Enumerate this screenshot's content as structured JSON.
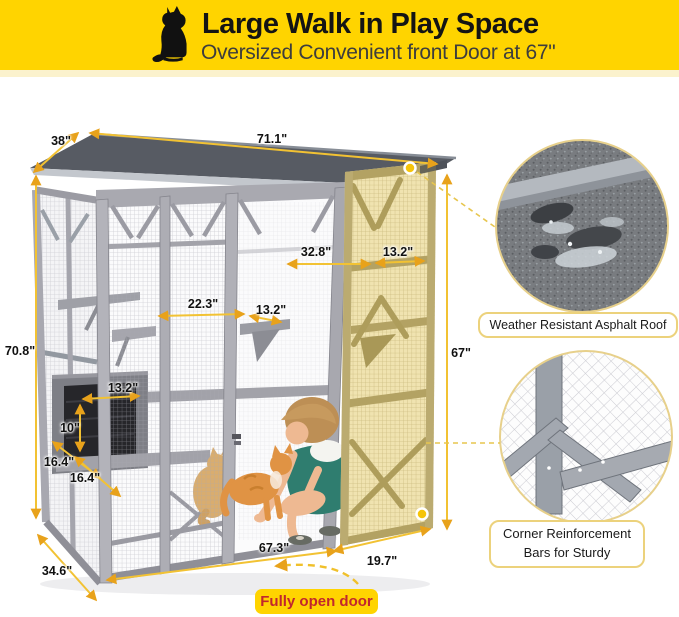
{
  "banner": {
    "title": "Large Walk in Play Space",
    "subtitle": "Oversized Convenient front Door at 67\"",
    "bg_color": "#FFD400",
    "title_color": "#141414",
    "subtitle_color": "#3d3d3d",
    "icon": "black-sitting-cat-silhouette"
  },
  "dims": [
    {
      "id": "roof-depth",
      "label": "38\""
    },
    {
      "id": "roof-width",
      "label": "71.1\""
    },
    {
      "id": "overall-height",
      "label": "70.8\""
    },
    {
      "id": "base-depth",
      "label": "34.6\""
    },
    {
      "id": "base-width",
      "label": "67.3\""
    },
    {
      "id": "door-bottom-width",
      "label": "19.7\""
    },
    {
      "id": "door-height",
      "label": "67\""
    },
    {
      "id": "shelf-gap-right",
      "label": "32.8\""
    },
    {
      "id": "door-shelf-width",
      "label": "13.2\""
    },
    {
      "id": "shelf-gap-mid",
      "label": "22.3\""
    },
    {
      "id": "mid-shelf-width",
      "label": "13.2\""
    },
    {
      "id": "house-shelf-width",
      "label": "13.2\""
    },
    {
      "id": "house-height",
      "label": "10\""
    },
    {
      "id": "lower-shelf-a",
      "label": "16.4\""
    },
    {
      "id": "lower-shelf-b",
      "label": "16.4\""
    }
  ],
  "callouts": [
    {
      "id": "roof",
      "label": "Weather Resistant Asphalt Roof"
    },
    {
      "id": "corner",
      "label": "Corner Reinforcement Bars for Sturdy"
    }
  ],
  "door_tag": {
    "label": "Fully open door",
    "text_color": "#C1272D",
    "bg_color": "#FFD400"
  },
  "colors": {
    "accent_yellow": "#FFD400",
    "dimension_line": "#F2C233",
    "arrowhead": "#E8A21B",
    "cage_gray": "#ABABB3",
    "roof_gray": "#575B63",
    "open_door_tan": "#EFE6C2"
  }
}
